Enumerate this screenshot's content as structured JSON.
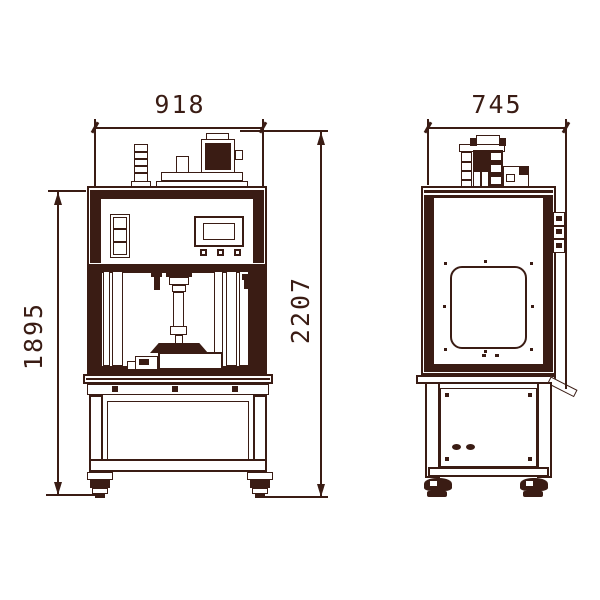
{
  "colors": {
    "ink": "#3a1c14",
    "paper": "#ffffff"
  },
  "drawing": {
    "kind": "two-view engineering drawing of a press machine",
    "views": [
      {
        "id": "front-view"
      },
      {
        "id": "side-view"
      }
    ],
    "dims": {
      "front_width": {
        "value": "918",
        "orientation": "horizontal"
      },
      "side_depth": {
        "value": "745",
        "orientation": "horizontal"
      },
      "frame_height": {
        "value": "1895",
        "orientation": "vertical"
      },
      "total_height": {
        "value": "2207",
        "orientation": "vertical"
      }
    }
  }
}
